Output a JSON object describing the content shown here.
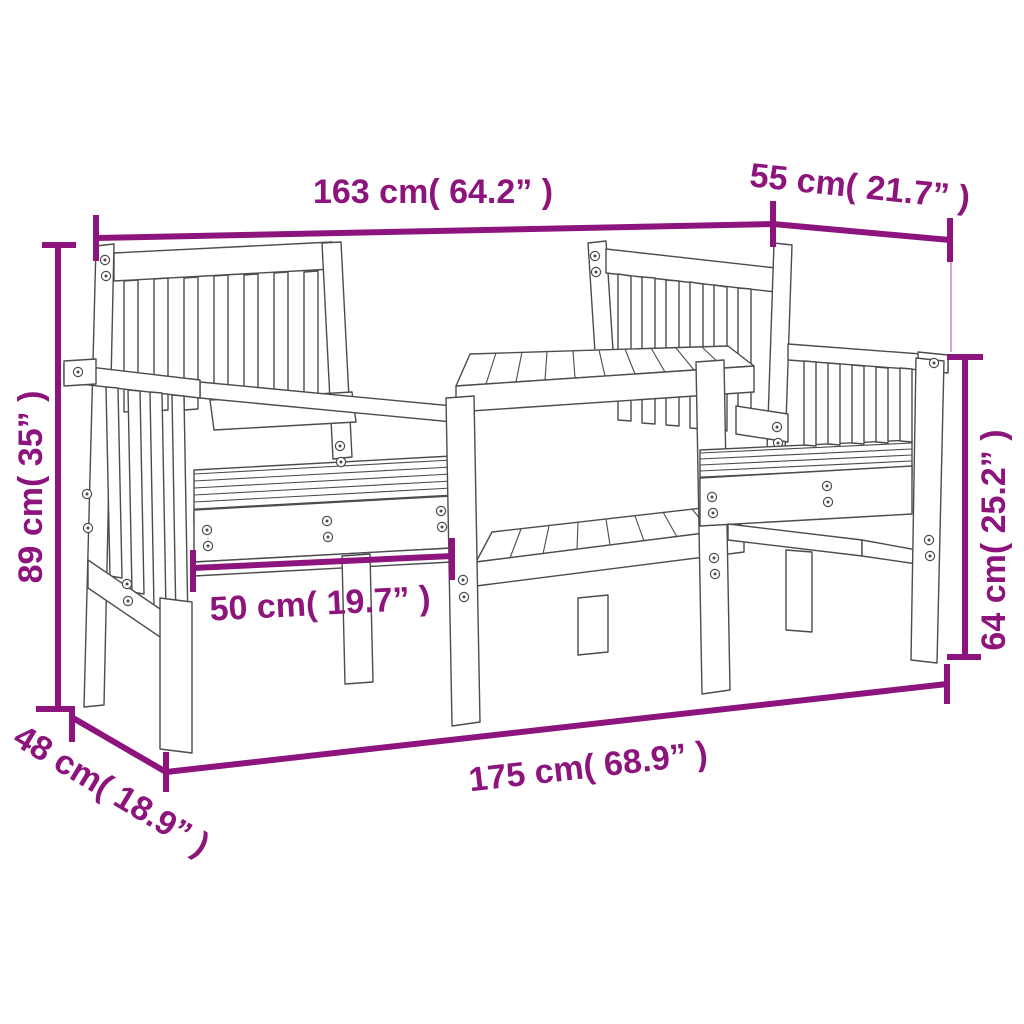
{
  "figure": {
    "type": "product-dimension-diagram",
    "subject": "2-seater garden bench with center table (outline drawing)",
    "colors": {
      "dimension_accent": "#8E147D",
      "dimension_light_connector": "#C9A0C6",
      "drawing_line": "#4C4C4C",
      "background": "#FFFFFF"
    },
    "dimensions": {
      "top_width": "163 cm( 64.2” )",
      "top_depth": "55 cm( 21.7” )",
      "left_height": "89 cm( 35” )",
      "right_height": "64 cm( 25.2” )",
      "seat_width": "50 cm( 19.7” )",
      "bottom_width": "175 cm( 68.9” )",
      "bottom_depth": "48 cm( 18.9” )"
    }
  }
}
